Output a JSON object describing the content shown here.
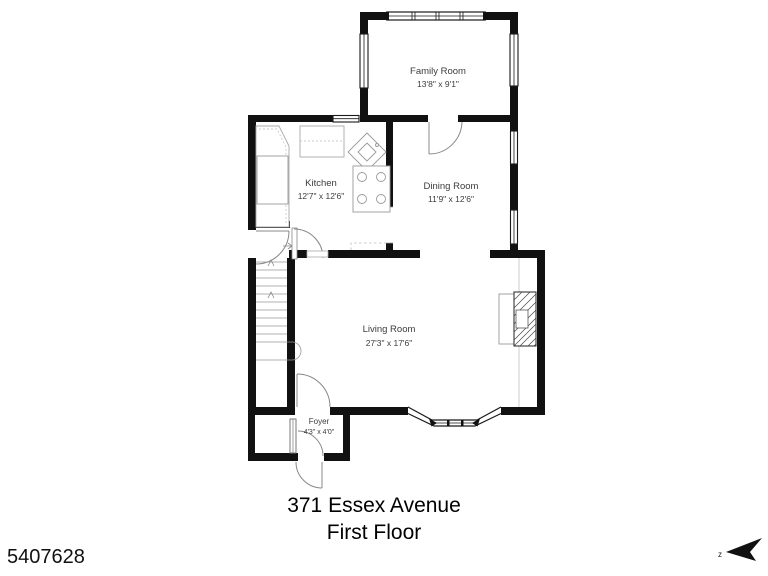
{
  "floorplan": {
    "listing_id": "5407628",
    "address_line": "371 Essex Avenue",
    "floor_line": "First Floor",
    "compass_label": "z",
    "colors": {
      "wall": "#111111",
      "fixture_line": "#999999"
    },
    "rooms": [
      {
        "name": "Family Room",
        "dims": "13'8\" x 9'1\""
      },
      {
        "name": "Kitchen",
        "dims": "12'7\" x 12'6\""
      },
      {
        "name": "Dining Room",
        "dims": "11'9\" x 12'6\""
      },
      {
        "name": "Living Room",
        "dims": "27'3\" x 17'6\""
      },
      {
        "name": "Foyer",
        "dims": "4'3\" x 4'0\""
      }
    ]
  }
}
